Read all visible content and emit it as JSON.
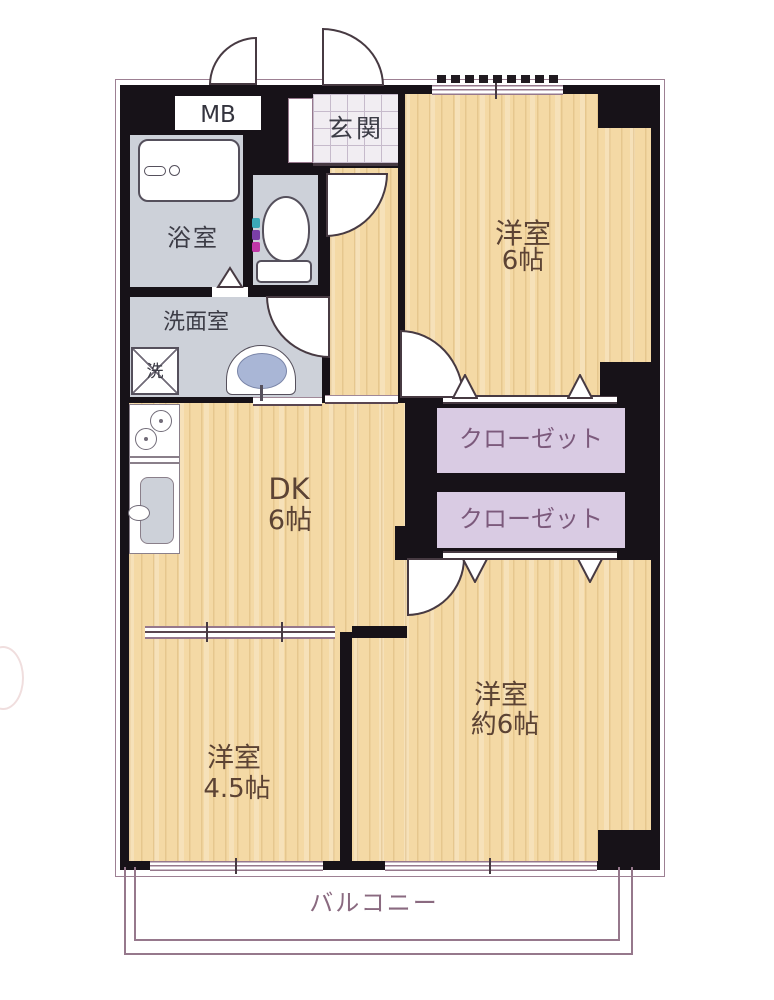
{
  "floorplan": {
    "mb": "MB",
    "genkan": "玄関",
    "bathroom": "浴室",
    "washroom": "洗面室",
    "washer": "洗",
    "closet_upper": "クローゼット",
    "closet_lower": "クローゼット",
    "room_top": {
      "name": "洋室",
      "size": "6帖"
    },
    "dk": {
      "name": "DK",
      "size": "6帖"
    },
    "room_left": {
      "name": "洋室",
      "size": "4.5帖"
    },
    "room_right": {
      "name": "洋室",
      "size": "約6帖"
    },
    "balcony": "バルコニー",
    "colors": {
      "wall": "#171218",
      "wood_floor": "#f4d9a5",
      "wet_floor": "#cdd1d9",
      "closet_fill": "#d9cbe3",
      "window_line": "#96788c",
      "room_label": "#5c4334",
      "wet_label": "#3c3c46",
      "closet_label": "#7c5a7c",
      "balcony_label": "#8a6a80"
    }
  }
}
